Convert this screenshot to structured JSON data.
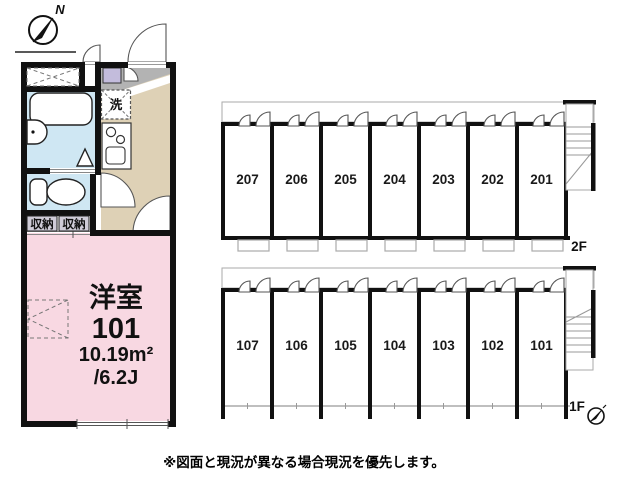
{
  "unit_plan": {
    "compass_label": "N",
    "room_type": "洋室",
    "room_number": "101",
    "area": "10.19m²",
    "tatami": "/6.2J",
    "laundry": "洗",
    "storage_left": "収納",
    "storage_right": "収納"
  },
  "building": {
    "floors": [
      {
        "label": "2F",
        "rooms": [
          "207",
          "206",
          "205",
          "204",
          "203",
          "202",
          "201"
        ]
      },
      {
        "label": "1F",
        "rooms": [
          "107",
          "106",
          "105",
          "104",
          "103",
          "102",
          "101"
        ]
      }
    ]
  },
  "footer": {
    "disclaimer": "※図面と現況が異なる場合現況を優先します。"
  },
  "colors": {
    "room_pink": "#f8d8e2",
    "wet_blue": "#cfe7f3",
    "kitchen_beige": "#ded1b6",
    "entry_gray": "#b3b3b3",
    "cabinet_purple": "#c3bcdc",
    "storage_gray": "#cfccd8",
    "wall_black": "#111111"
  }
}
